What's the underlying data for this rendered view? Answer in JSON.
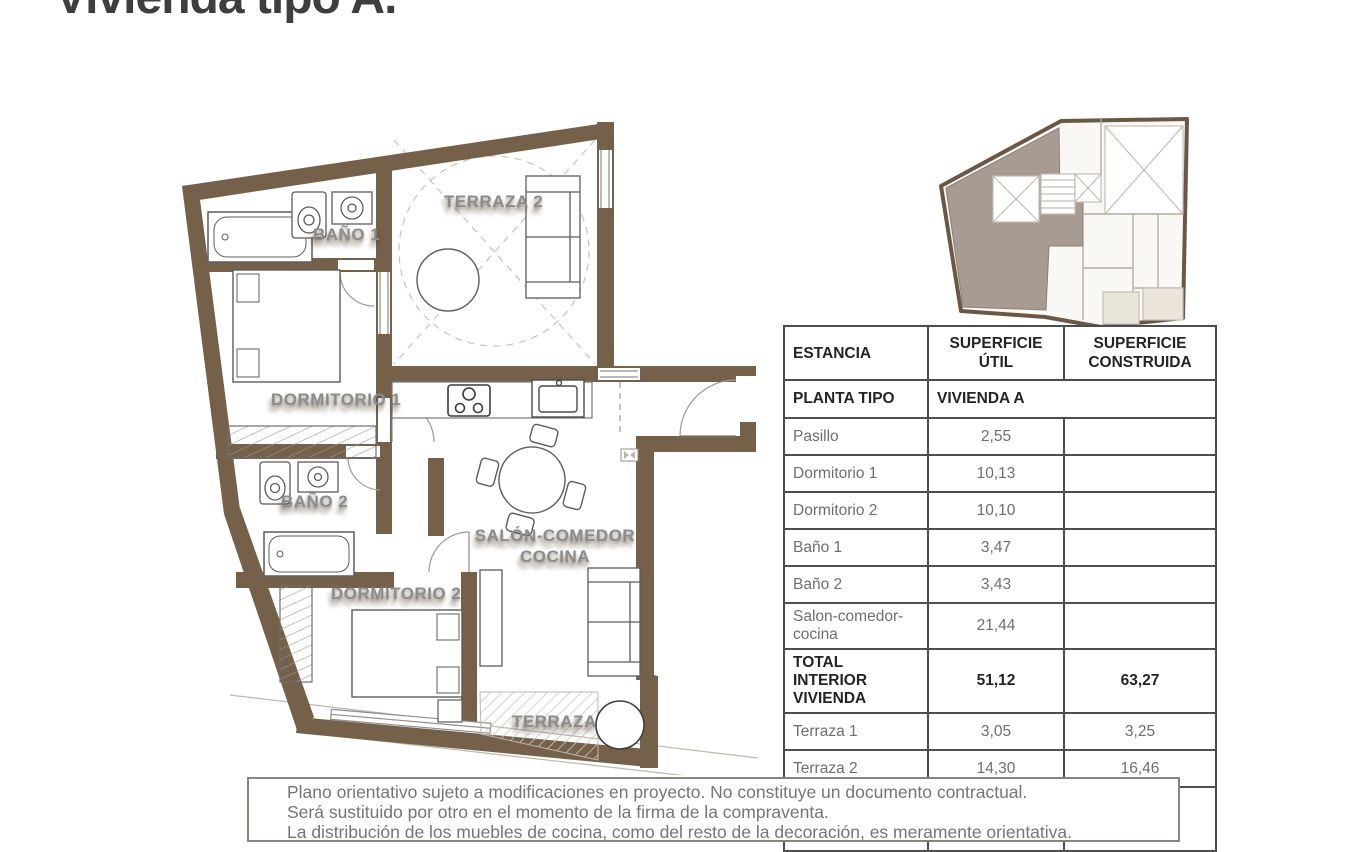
{
  "header": {
    "title": "Vivienda tipo A."
  },
  "plan": {
    "labels": {
      "terraza2": "TERRAZA 2",
      "bano1": "BAÑO 1",
      "dormitorio1": "DORMITORIO 1",
      "bano2": "BAÑO 2",
      "dormitorio2": "DORMITORIO 2",
      "salon1": "SALÓN-COMEDOR",
      "salon2": "COCINA",
      "terraza": "TERRAZA"
    },
    "colors": {
      "wall_brown": "#75614a",
      "keyplan_highlight": "#a89c92",
      "label_gray": "#8c8c8c"
    }
  },
  "table": {
    "headers": [
      "ESTANCIA",
      "SUPERFICIE ÚTIL",
      "SUPERFICIE CONSTRUIDA"
    ],
    "subheader": {
      "col1": "PLANTA TIPO",
      "col2": "VIVIENDA A"
    },
    "rows": [
      {
        "name": "Pasillo",
        "util": "2,55",
        "construida": ""
      },
      {
        "name": "Dormitorio 1",
        "util": "10,13",
        "construida": ""
      },
      {
        "name": "Dormitorio 2",
        "util": "10,10",
        "construida": ""
      },
      {
        "name": "Baño 1",
        "util": "3,47",
        "construida": ""
      },
      {
        "name": "Baño 2",
        "util": "3,43",
        "construida": ""
      },
      {
        "name": "Salon-comedor-cocina",
        "util": "21,44",
        "construida": ""
      },
      {
        "name": "TOTAL INTERIOR VIVIENDA",
        "util": "51,12",
        "construida": "63,27"
      },
      {
        "name": "Terraza 1",
        "util": "3,05",
        "construida": "3,25"
      },
      {
        "name": "Terraza 2",
        "util": "14,30",
        "construida": "16,46"
      },
      {
        "name": "TOTAL VIVIENDA + TERRAZAS",
        "util": "65,84",
        "construida": "78,55"
      }
    ]
  },
  "footer": {
    "lines": [
      "Plano orientativo sujeto a modificaciones en proyecto. No constituye un documento contractual.",
      "Será sustituido por otro en el momento de la firma de la compraventa.",
      "La distribución de los muebles de cocina, como del resto de la decoración, es meramente orientativa."
    ]
  }
}
